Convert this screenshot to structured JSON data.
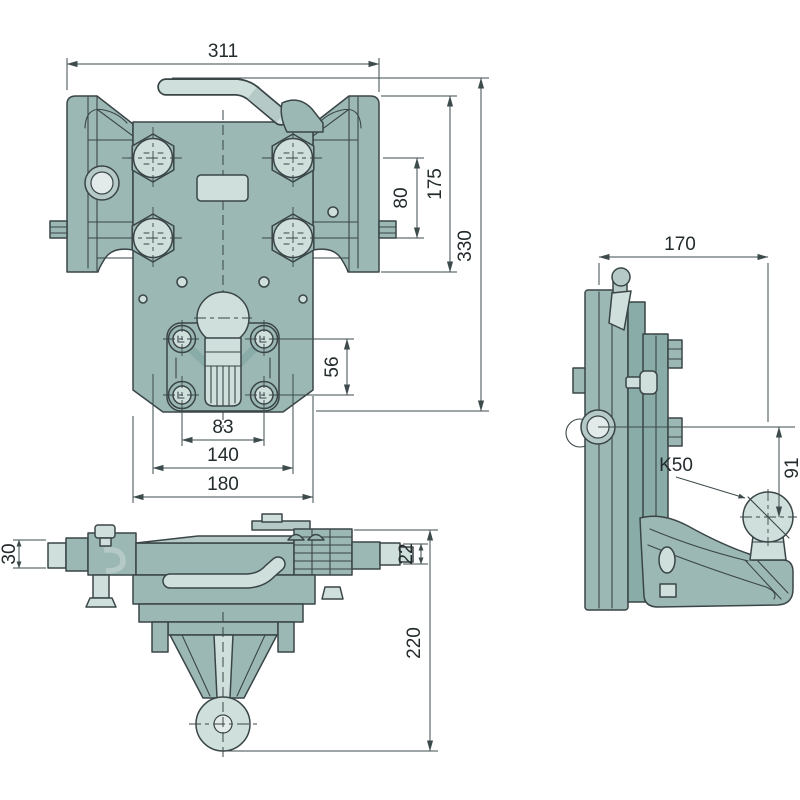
{
  "colors": {
    "background": "#ffffff",
    "body": "#9cb8b5",
    "body_dark": "#8aaca9",
    "body_mid": "#b5cac7",
    "light": "#cfdfdb",
    "lighter": "#e2ebe9",
    "outline": "#3a4547",
    "dimension": "#3d4b4d"
  },
  "front_view": {
    "dims": {
      "overall_width": "311",
      "overall_height": "330",
      "flange_height": "175",
      "bolt_row_spacing": "80",
      "lower_bolt_row_spacing": "56",
      "lower_bolt_col_spacing": "83",
      "bolt_col_spacing": "140",
      "plate_width": "180"
    }
  },
  "side_view": {
    "dims": {
      "overall_depth": "170",
      "ball_drop": "91"
    },
    "labels": {
      "ball_type": "K50"
    }
  },
  "bottom_view": {
    "dims": {
      "left_pin_width": "30",
      "right_pin_width": "22",
      "overall_depth": "220"
    }
  }
}
